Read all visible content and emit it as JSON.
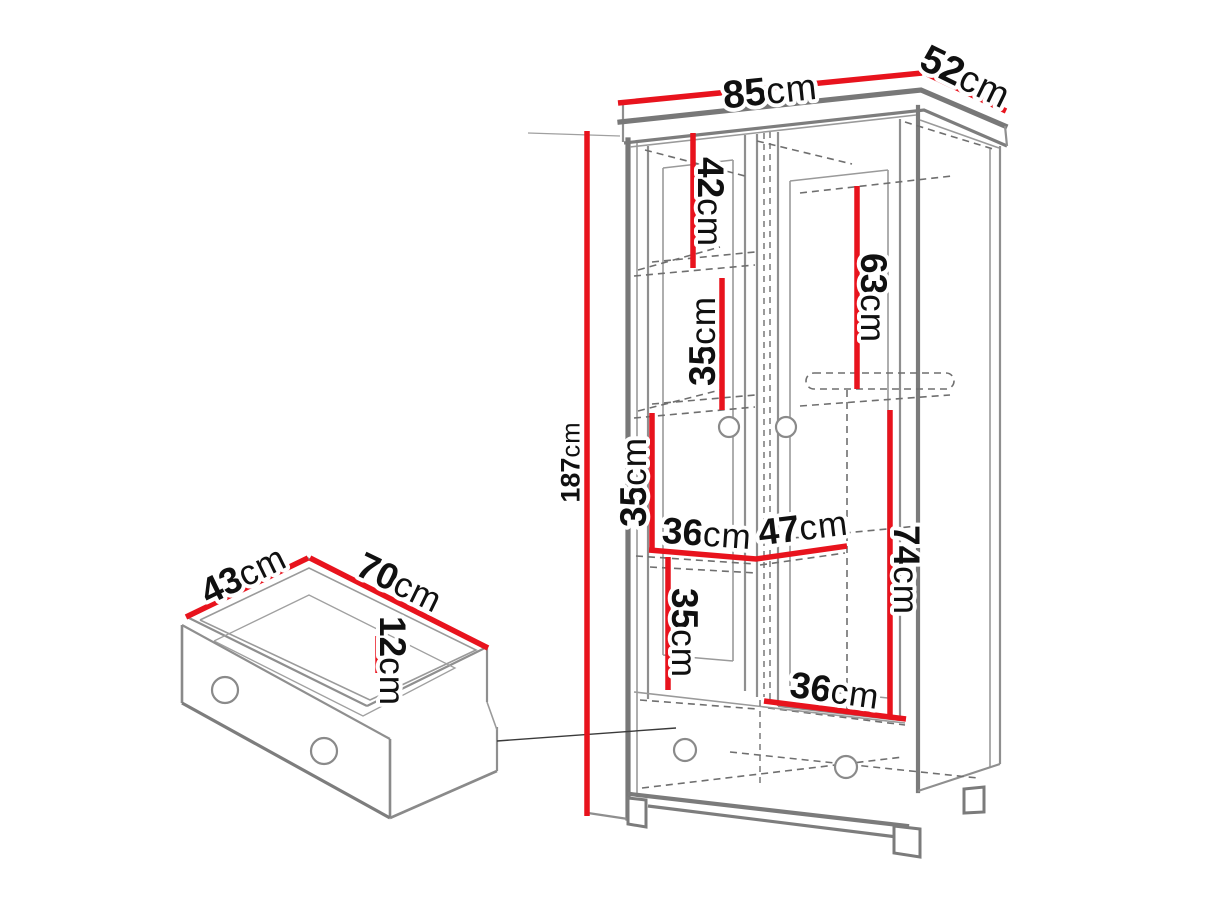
{
  "diagram": {
    "type": "furniture-dimension-diagram",
    "subject": "two-door wardrobe with bottom drawer",
    "unit": "cm",
    "colors": {
      "dimension_line": "#e8131d",
      "structure_line": "#8f8f8f",
      "text": "#101010",
      "background": "#ffffff"
    },
    "labels": {
      "wardrobe_width": {
        "num": "85",
        "unit": "cm"
      },
      "wardrobe_depth": {
        "num": "52",
        "unit": "cm"
      },
      "wardrobe_height": {
        "num": "187",
        "unit": "cm"
      },
      "int_top_left": {
        "num": "42",
        "unit": "cm"
      },
      "int_top_right": {
        "num": "63",
        "unit": "cm"
      },
      "int_shelf2": {
        "num": "35",
        "unit": "cm"
      },
      "int_shelf3": {
        "num": "35",
        "unit": "cm"
      },
      "int_width_left": {
        "num": "36",
        "unit": "cm"
      },
      "int_width_right": {
        "num": "47",
        "unit": "cm"
      },
      "int_right_height": {
        "num": "74",
        "unit": "cm"
      },
      "int_shelf4": {
        "num": "35",
        "unit": "cm"
      },
      "int_width_bottom": {
        "num": "36",
        "unit": "cm"
      },
      "drawer_depth": {
        "num": "43",
        "unit": "cm"
      },
      "drawer_width": {
        "num": "70",
        "unit": "cm"
      },
      "drawer_height": {
        "num": "12",
        "unit": "cm"
      }
    }
  }
}
